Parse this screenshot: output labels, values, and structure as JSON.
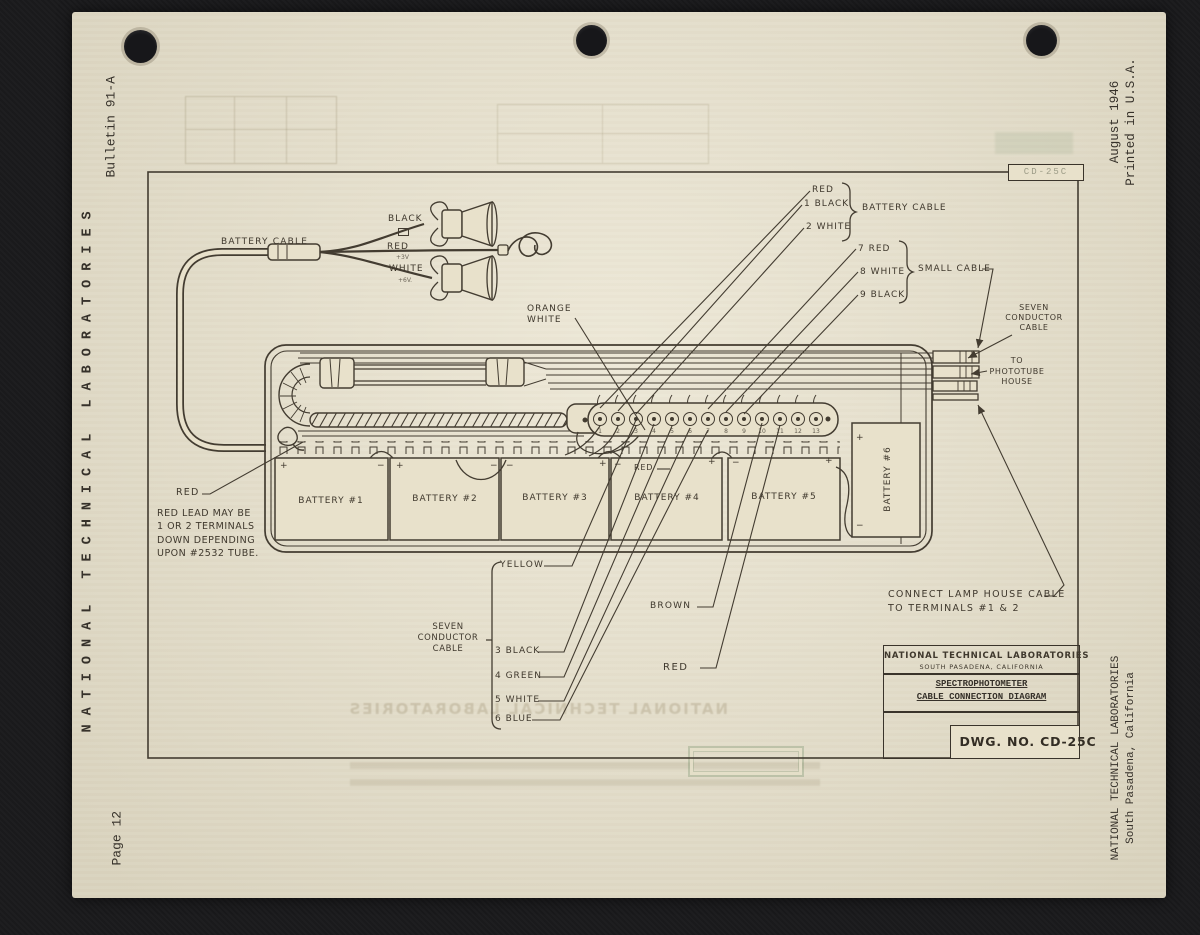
{
  "page": {
    "margins": {
      "bulletin": "Bulletin 91-A",
      "left_org": "NATIONAL TECHNICAL LABORATORIES",
      "page_number": "Page 12",
      "date_line1": "August 1946",
      "date_line2": "Printed in U.S.A.",
      "right_org_line1": "NATIONAL TECHNICAL LABORATORIES",
      "right_org_line2": "South Pasadena, California"
    },
    "stamp": "CD-25C",
    "ghost_text": "NATIONAL TECHNICAL LABORATORIES",
    "colors": {
      "paper": "#e8e1cb",
      "ink": "#3a342b",
      "background": "#1a1a1c"
    }
  },
  "diagram": {
    "cable_assembly": {
      "label": "BATTERY CABLE",
      "black_wire": "BLACK",
      "red_wire": "RED",
      "white_wire": "WHITE",
      "red_marking": "+3V",
      "white_marking": "+6V."
    },
    "top_labels": {
      "red": "RED",
      "black1": "1 BLACK",
      "white2": "2 WHITE",
      "battery_cable": "BATTERY CABLE",
      "red7": "7 RED",
      "white8": "8 WHITE",
      "black9": "9 BLACK",
      "small_cable": "SMALL CABLE",
      "seven_conductor": [
        "SEVEN",
        "CONDUCTOR",
        "CABLE"
      ],
      "phototube": [
        "TO",
        "PHOTOTUBE",
        "HOUSE"
      ]
    },
    "orange_white": [
      "ORANGE",
      "WHITE"
    ],
    "left_red": "RED",
    "red_note": [
      "RED LEAD MAY BE",
      "1 OR 2 TERMINALS",
      "DOWN DEPENDING",
      "UPON #2532 TUBE."
    ],
    "bottom_labels": {
      "yellow": "YELLOW",
      "seven_line1": "SEVEN",
      "seven_line2": "CONDUCTOR CABLE",
      "black3": "3 BLACK",
      "green4": "4 GREEN",
      "white5": "5 WHITE",
      "blue6": "6 BLUE",
      "brown": "BROWN",
      "red": "RED"
    },
    "inner_red": "RED",
    "connect_note": [
      "CONNECT LAMP HOUSE CABLE",
      "TO TERMINALS #1 & 2"
    ],
    "batteries": [
      {
        "label": "BATTERY #1",
        "left_sign": "+",
        "right_sign": "−"
      },
      {
        "label": "BATTERY #2",
        "left_sign": "+",
        "right_sign": "−"
      },
      {
        "label": "BATTERY #3",
        "left_sign": "−",
        "right_sign": "+"
      },
      {
        "label": "BATTERY #4",
        "left_sign": "−",
        "right_sign": "+"
      },
      {
        "label": "BATTERY #5",
        "left_sign": "−",
        "right_sign": "+"
      },
      {
        "label": "BATTERY #6",
        "top_sign": "+",
        "bottom_sign": "−"
      }
    ],
    "terminal_numbers": [
      "1",
      "2",
      "3",
      "4",
      "5",
      "6",
      "7",
      "8",
      "9",
      "10",
      "11",
      "12",
      "13"
    ],
    "title_block": {
      "company": "NATIONAL TECHNICAL LABORATORIES",
      "city": "SOUTH PASADENA, CALIFORNIA",
      "title_line1": "SPECTROPHOTOMETER",
      "title_line2": "CABLE CONNECTION DIAGRAM",
      "dwg_no": "DWG. NO. CD-25C"
    }
  }
}
